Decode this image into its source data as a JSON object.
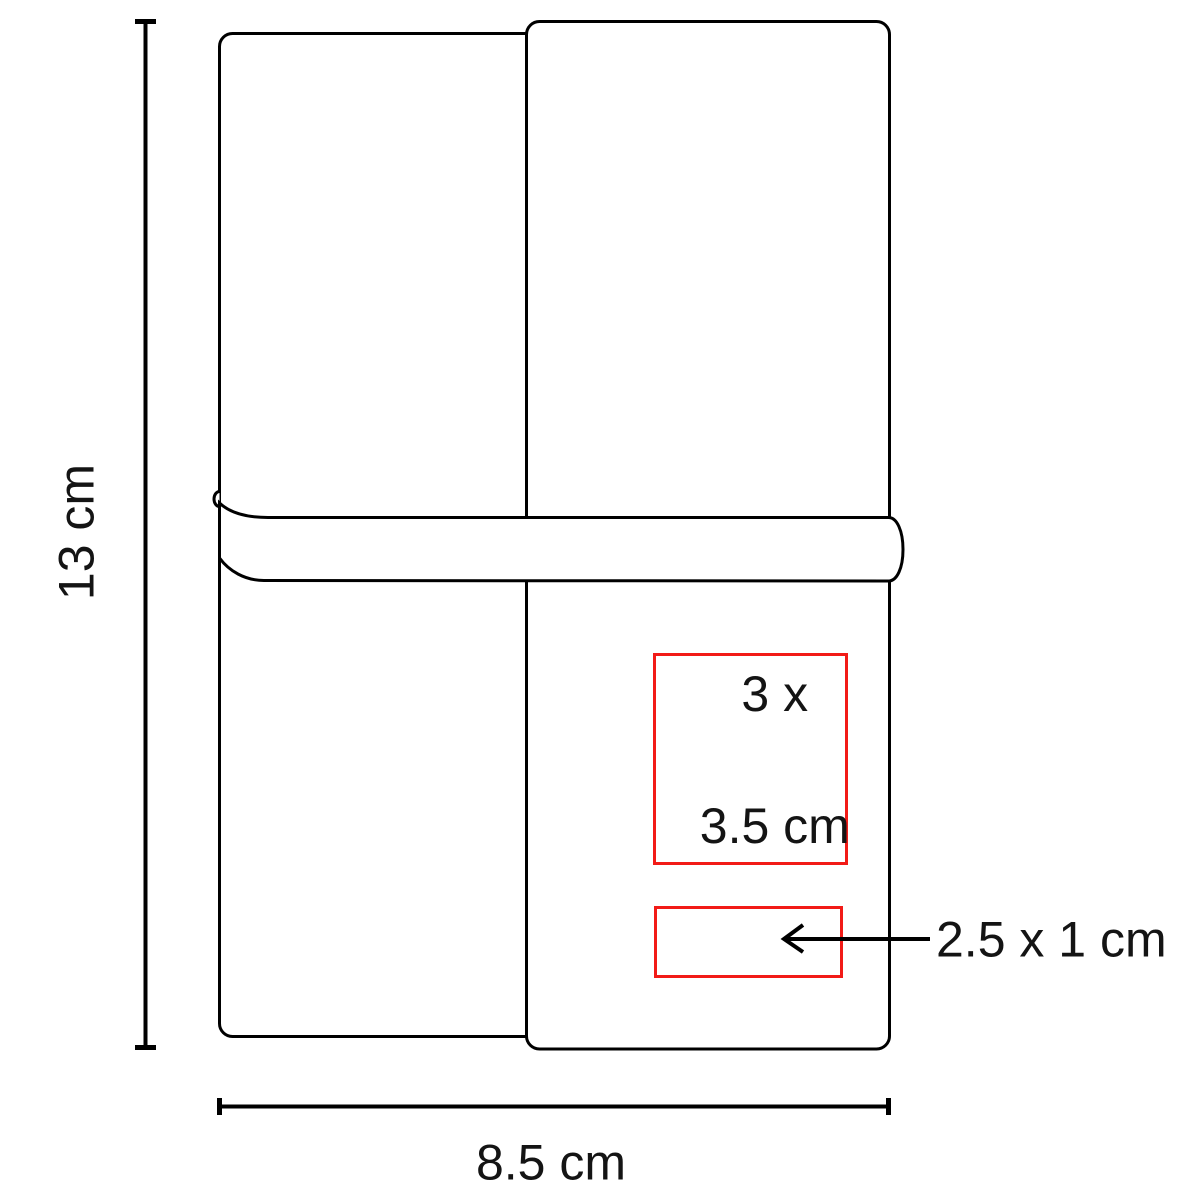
{
  "diagram": {
    "colors": {
      "outline": "#000000",
      "highlight_red": "#f21b17",
      "background": "#ffffff"
    },
    "dimensions": {
      "height_label": "13 cm",
      "width_label": "8.5 cm",
      "large_area_label_line1": "3 x",
      "large_area_label_line2": "3.5 cm",
      "small_area_label": "2.5 x 1 cm"
    }
  }
}
